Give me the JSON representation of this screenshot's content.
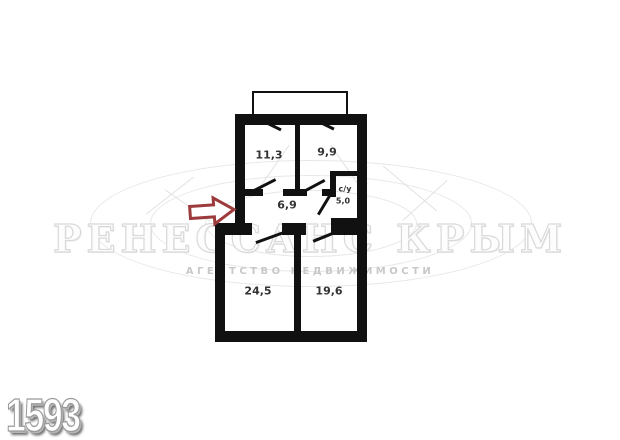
{
  "watermark": {
    "title": "РЕНЕССАНС КРЫМ",
    "subtitle": "АГЕНТСТВО НЕДВИЖИМОСТИ"
  },
  "photo_id": "1593",
  "plan": {
    "rooms": [
      {
        "name": "room-top-left",
        "area": "11,3"
      },
      {
        "name": "room-top-right",
        "area": "9,9"
      },
      {
        "name": "hallway",
        "area": "6,9"
      },
      {
        "name": "bathroom",
        "label": "с/у",
        "area": "5,0"
      },
      {
        "name": "room-bottom-left",
        "area": "24,5"
      },
      {
        "name": "room-bottom-right",
        "area": "19,6"
      }
    ]
  },
  "theme": {
    "wall": "#111111",
    "arrow": "#9c3a3c",
    "watermark-big": "#d9d9d9",
    "watermark-small": "#c8c8c8",
    "label": "#333333"
  }
}
